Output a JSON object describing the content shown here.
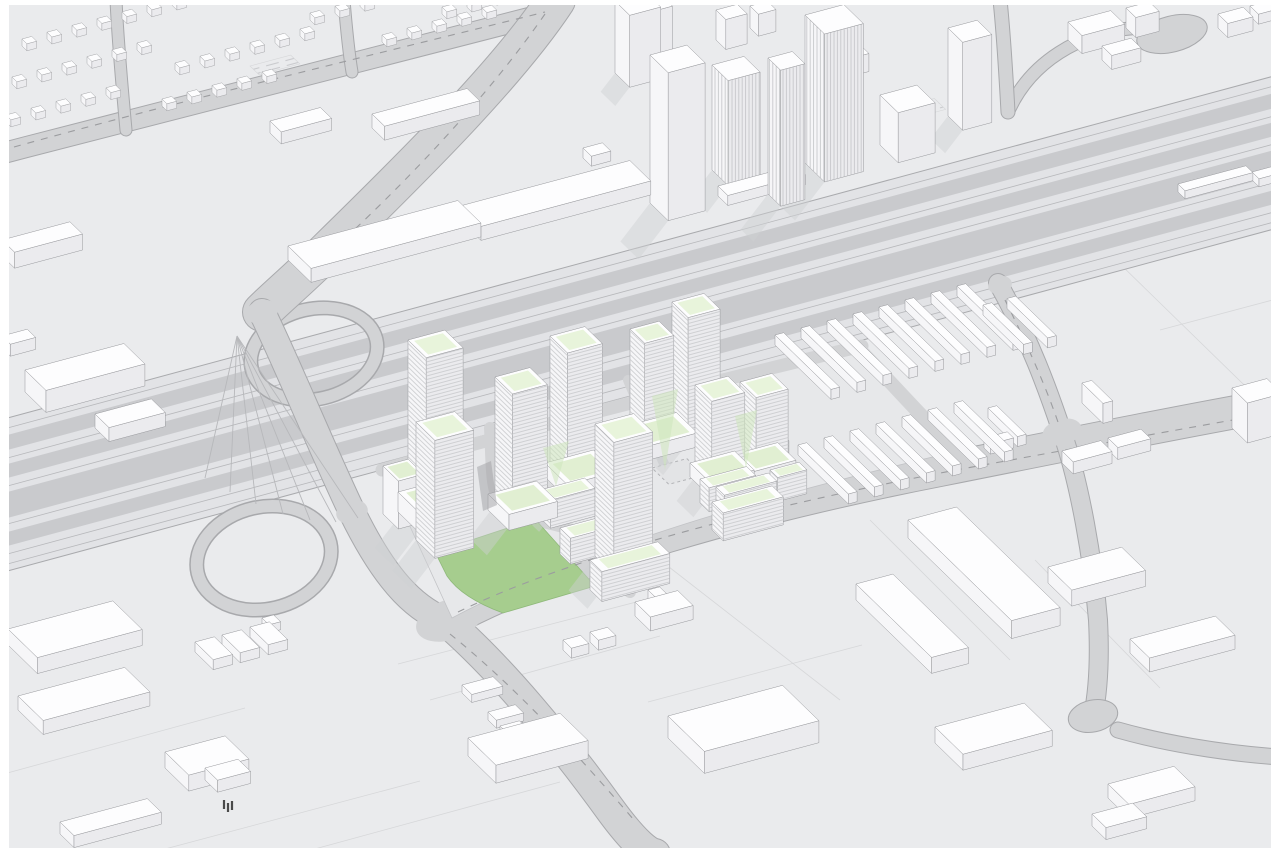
{
  "colors": {
    "frame": "#ffffff",
    "ground": "#eaebed",
    "block_line": "#d6d7d9",
    "corridor_base": "#e2e3e6",
    "corridor_band": "#c9cacd",
    "corridor_line": "#b7b8bb",
    "corridor_edge": "#a9aaad",
    "road": "#d2d3d5",
    "road_edge": "#a8a9ac",
    "road_dash": "#9b9c9f",
    "site": "#e7e8ea",
    "site_edge": "#c2c3c6",
    "lawn": "#a6cd8e",
    "lawn_edge": "#8fb97a",
    "roof_top": "#fdfdfe",
    "face_left": "#f6f6f8",
    "face_right": "#ebebee",
    "outline": "#97989c",
    "house_outline": "#a5a6a9",
    "mint": "#e8f4db",
    "mint_podium": "#e1efd2",
    "shadow": "#cfd0d3",
    "plaza": "#e3e4e6",
    "plaza_dash": "#b3b4b7",
    "stripe": "#c6c7ca",
    "vstripe": "#c2c3c6",
    "hatch": "#c9cacd",
    "shade_green": "#cde5bb",
    "gap_shadow": "#9fa0a3",
    "tree": "#4a4a4a"
  },
  "scene": {
    "corridor": {
      "top": [
        0,
        420
      ],
      "drop": 345.6,
      "height": 153,
      "bands": [
        [
          17,
          32
        ],
        [
          46,
          60
        ],
        [
          74,
          100
        ],
        [
          114,
          128
        ]
      ],
      "lines": [
        10,
        40,
        68,
        106,
        136,
        146
      ]
    },
    "roads": [
      {
        "n": "northwest-avenue",
        "d": "M 0,154 C 180,106 360,62 560,10",
        "w": 20
      },
      {
        "n": "cross-street-1",
        "d": "M 126,130 C 122,86 118,44 116,0",
        "w": 11
      },
      {
        "n": "cross-street-2",
        "d": "M 352,72 C 348,48 346,24 344,0",
        "w": 11
      },
      {
        "n": "north-approach-road",
        "d": "M 556,0 C 510,70 420,160 330,248 C 300,278 278,296 262,312",
        "w": 38
      },
      {
        "n": "overpass-bridge",
        "d": "M 262,312 C 290,370 318,440 352,512 C 390,590 420,610 447,622",
        "w": 26
      },
      {
        "n": "south-arterial",
        "d": "M 447,622 C 500,668 560,740 612,812 C 635,843 648,853 655,854",
        "w": 30
      },
      {
        "n": "development-front-street",
        "d": "M 447,622 C 560,560 760,505 940,470 C 1100,438 1200,418 1280,404",
        "w": 32
      },
      {
        "n": "east-street",
        "d": "M 998,283 C 1030,340 1048,390 1062,432 C 1080,484 1093,560 1098,620 C 1100,660 1098,692 1093,716",
        "w": 18
      },
      {
        "n": "cul-de-sac-street",
        "d": "M 1280,757 C 1220,753 1160,742 1118,730",
        "w": 15
      },
      {
        "n": "ramp-street",
        "d": "M 1008,112 C 1030,62 1080,32 1135,28",
        "w": 12
      },
      {
        "n": "top-right-road",
        "d": "M 1000,0 C 1004,38 1006,76 1008,112",
        "w": 13
      }
    ],
    "loops": [
      {
        "n": "loop-ramp-north",
        "cx": 314,
        "cy": 354,
        "rx": 64,
        "ry": 45,
        "rot": -13
      },
      {
        "n": "loop-ramp-south",
        "cx": 264,
        "cy": 558,
        "rx": 68,
        "ry": 51,
        "rot": -13
      }
    ],
    "teardrop": {
      "cx": 1172,
      "cy": 34,
      "rx": 36,
      "ry": 18,
      "rot": -14
    },
    "bulb": {
      "cx": 1093,
      "cy": 716,
      "rx": 25,
      "ry": 16,
      "rot": -12
    },
    "patches": [
      [
        449,
        620,
        34,
        20,
        -18
      ],
      [
        352,
        512,
        16,
        12,
        -14
      ],
      [
        262,
        312,
        16,
        12,
        -14
      ],
      [
        1062,
        432,
        20,
        13,
        -16
      ],
      [
        1000,
        285,
        12,
        9,
        -14
      ]
    ],
    "fan": {
      "apex": [
        237,
        336
      ],
      "feet": [
        [
          205,
          478
        ],
        [
          230,
          492
        ],
        [
          256,
          504
        ],
        [
          283,
          514
        ],
        [
          310,
          520
        ],
        [
          336,
          522
        ],
        [
          358,
          518
        ]
      ]
    },
    "inner_streets": [
      {
        "n": "development-back-street",
        "d": "M 382,470 C 520,430 700,385 862,346",
        "w": 13
      },
      {
        "n": "development-street-1",
        "d": "M 490,428 C 492,462 490,492 502,506 C 520,523 560,520 588,538 C 612,554 622,572 630,592",
        "w": 12
      },
      {
        "n": "development-street-2",
        "d": "M 628,380 C 645,420 658,452 668,472",
        "w": 10
      },
      {
        "n": "development-street-3",
        "d": "M 858,348 C 900,392 930,426 958,452",
        "w": 14
      }
    ],
    "dashes": [
      "M 458,612 C 575,555 775,502 1000,462 C 1120,440 1210,424 1278,412",
      "M 450,634 C 512,684 572,748 634,820",
      "M 545,14 C 498,82 430,158 354,230",
      "M 14,147 C 180,101 360,58 545,12",
      "M 1005,300 C 1030,350 1048,392 1060,428"
    ],
    "site": "M 385,472 L 858,345 L 962,450 C 800,488 598,540 452,618 Z",
    "lawn": "M 535,519 L 595,586 L 503,613 Q 462,598 447,576 L 435,552 Z",
    "plaza": {
      "x": 652,
      "y": 468,
      "w": 36,
      "d": 24
    },
    "parking_lots": [
      [
        250,
        66,
        42,
        13
      ],
      [
        884,
        112,
        52,
        16
      ]
    ],
    "lot_lines": [
      [
        0,
        775,
        245,
        708
      ],
      [
        150,
        853,
        420,
        781
      ],
      [
        300,
        853,
        560,
        782
      ],
      [
        430,
        700,
        660,
        636
      ],
      [
        648,
        702,
        862,
        645
      ],
      [
        870,
        520,
        1010,
        660
      ],
      [
        1035,
        560,
        1160,
        688
      ],
      [
        1160,
        330,
        1280,
        298
      ],
      [
        1185,
        207,
        1280,
        182
      ],
      [
        1118,
        262,
        1278,
        418
      ],
      [
        398,
        664,
        640,
        601
      ],
      [
        660,
        560,
        840,
        700
      ]
    ],
    "green_shades": [
      [
        [
          543,
          448
        ],
        [
          569,
          441
        ],
        [
          556,
          486
        ]
      ],
      [
        [
          652,
          396
        ],
        [
          678,
          389
        ],
        [
          665,
          470
        ]
      ],
      [
        [
          735,
          416
        ],
        [
          757,
          410
        ],
        [
          746,
          468
        ]
      ]
    ],
    "dark_gap": [
      [
        477,
        467
      ],
      [
        491,
        461
      ],
      [
        497,
        505
      ],
      [
        483,
        511
      ]
    ],
    "trees": [
      [
        224,
        800
      ],
      [
        228,
        803
      ],
      [
        232,
        801
      ]
    ],
    "boxes": [
      [
        408,
        505,
        38,
        26,
        165,
        "t",
        "proposed-tower-a1"
      ],
      [
        398,
        512,
        54,
        32,
        20,
        "p",
        "podium-a1"
      ],
      [
        383,
        514,
        26,
        22,
        48,
        "p",
        "terrace-a2"
      ],
      [
        416,
        540,
        40,
        27,
        118,
        "t",
        "proposed-tower-a2"
      ],
      [
        495,
        505,
        36,
        25,
        128,
        "t",
        "proposed-tower-b1"
      ],
      [
        488,
        510,
        50,
        30,
        16,
        "p",
        "podium-b1"
      ],
      [
        545,
        477,
        50,
        32,
        14,
        "p",
        "podium-c1"
      ],
      [
        550,
        478,
        36,
        25,
        142,
        "t",
        "proposed-tower-c1"
      ],
      [
        626,
        440,
        52,
        30,
        14,
        "p",
        "podium-d"
      ],
      [
        630,
        441,
        30,
        21,
        112,
        "t",
        "proposed-tower-d1"
      ],
      [
        672,
        427,
        33,
        23,
        125,
        "t",
        "proposed-tower-d2"
      ],
      [
        595,
        556,
        40,
        27,
        132,
        "t",
        "proposed-tower-e1"
      ],
      [
        690,
        477,
        46,
        28,
        14,
        "p",
        "podium-f1"
      ],
      [
        695,
        477,
        34,
        24,
        92,
        "t",
        "proposed-tower-f1"
      ],
      [
        735,
        466,
        44,
        26,
        12,
        "p",
        "podium-f2"
      ],
      [
        740,
        467,
        33,
        23,
        85,
        "t",
        "proposed-tower-f2"
      ],
      [
        540,
        518,
        46,
        15,
        28,
        "s",
        "midrise-slab-1"
      ],
      [
        560,
        554,
        50,
        15,
        26,
        "s",
        "midrise-slab-2"
      ],
      [
        590,
        590,
        70,
        17,
        30,
        "s",
        "midrise-slab-3"
      ],
      [
        712,
        530,
        62,
        16,
        28,
        "s",
        "midrise-slab-4"
      ],
      [
        716,
        527,
        54,
        12,
        40,
        "s",
        "midrise-slab-4-upper"
      ],
      [
        700,
        503,
        48,
        13,
        24,
        "s",
        "midrise-slab-5"
      ],
      [
        756,
        468,
        26,
        11,
        28,
        "s",
        "midrise-slab-6"
      ],
      [
        770,
        494,
        30,
        11,
        24,
        "s",
        "midrise-slab-7"
      ],
      [
        650,
        203,
        38,
        26,
        148,
        "w",
        "existing-tower-1"
      ],
      [
        615,
        73,
        32,
        21,
        72,
        "w",
        "existing-tower-2"
      ],
      [
        712,
        170,
        33,
        23,
        105,
        "v",
        "existing-tower-3"
      ],
      [
        768,
        194,
        25,
        18,
        136,
        "v",
        "existing-tower-4"
      ],
      [
        805,
        163,
        40,
        28,
        148,
        "v",
        "existing-tower-5"
      ],
      [
        718,
        196,
        80,
        14,
        10,
        "w",
        "existing-podium"
      ],
      [
        880,
        145,
        38,
        26,
        50,
        "w",
        "existing-midrise"
      ],
      [
        948,
        116,
        30,
        21,
        88,
        "w",
        "existing-tower-6"
      ],
      [
        636,
        50,
        26,
        16,
        48,
        "w",
        "building"
      ],
      [
        716,
        40,
        22,
        14,
        30,
        "w",
        "building"
      ],
      [
        750,
        28,
        18,
        12,
        22,
        "w",
        "building"
      ],
      [
        843,
        68,
        18,
        12,
        18,
        "w",
        "building"
      ],
      [
        270,
        133,
        52,
        16,
        12,
        "w",
        "retail-box-1"
      ],
      [
        372,
        128,
        98,
        18,
        14,
        "w",
        "retail-box-2"
      ],
      [
        288,
        260,
        175,
        33,
        14,
        "w",
        "retail-box-3"
      ],
      [
        460,
        220,
        175,
        30,
        14,
        "w",
        "retail-box-4"
      ],
      [
        583,
        158,
        20,
        12,
        10,
        "w",
        "building"
      ],
      [
        2,
        256,
        70,
        18,
        16,
        "w",
        "building"
      ],
      [
        2,
        348,
        26,
        12,
        12,
        "w",
        "building"
      ],
      [
        25,
        392,
        102,
        30,
        22,
        "w",
        "building"
      ],
      [
        95,
        428,
        58,
        20,
        14,
        "w",
        "building"
      ],
      [
        8,
        645,
        108,
        42,
        16,
        "w",
        "warehouse"
      ],
      [
        18,
        710,
        110,
        36,
        14,
        "w",
        "warehouse"
      ],
      [
        195,
        652,
        20,
        26,
        10,
        "w",
        "shed"
      ],
      [
        222,
        645,
        20,
        26,
        10,
        "w",
        "shed"
      ],
      [
        250,
        637,
        20,
        26,
        10,
        "w",
        "shed"
      ],
      [
        262,
        626,
        12,
        10,
        8,
        "w",
        "shed"
      ],
      [
        165,
        768,
        62,
        34,
        16,
        "w",
        "warehouse"
      ],
      [
        60,
        834,
        90,
        20,
        12,
        "w",
        "warehouse"
      ],
      [
        205,
        780,
        34,
        18,
        12,
        "w",
        "building"
      ],
      [
        212,
        776,
        10,
        8,
        19,
        "w",
        "rooftop-unit"
      ],
      [
        468,
        756,
        95,
        40,
        18,
        "w",
        "big-box-store"
      ],
      [
        500,
        752,
        20,
        14,
        26,
        "w",
        "rooftop-unit"
      ],
      [
        635,
        616,
        44,
        22,
        14,
        "w",
        "building"
      ],
      [
        648,
        612,
        12,
        10,
        22,
        "w",
        "rooftop-unit"
      ],
      [
        563,
        650,
        18,
        12,
        10,
        "w",
        "building"
      ],
      [
        590,
        642,
        18,
        12,
        10,
        "w",
        "building"
      ],
      [
        462,
        693,
        32,
        14,
        8,
        "w",
        "building"
      ],
      [
        488,
        720,
        28,
        12,
        8,
        "w",
        "building"
      ],
      [
        668,
        738,
        118,
        52,
        22,
        "w",
        "warehouse"
      ],
      [
        908,
        538,
        50,
        148,
        18,
        "w",
        "warehouse-long-1"
      ],
      [
        856,
        600,
        38,
        108,
        16,
        "w",
        "warehouse-long-2"
      ],
      [
        935,
        743,
        92,
        40,
        16,
        "w",
        "warehouse"
      ],
      [
        1048,
        583,
        76,
        34,
        16,
        "w",
        "warehouse"
      ],
      [
        1130,
        653,
        88,
        28,
        14,
        "w",
        "warehouse"
      ],
      [
        1108,
        798,
        68,
        30,
        14,
        "w",
        "warehouse"
      ],
      [
        1092,
        826,
        42,
        20,
        12,
        "w",
        "warehouse"
      ],
      [
        1062,
        463,
        40,
        16,
        12,
        "w",
        "building"
      ],
      [
        1108,
        450,
        34,
        14,
        12,
        "w",
        "building"
      ],
      [
        1082,
        403,
        10,
        30,
        20,
        "w",
        "building"
      ],
      [
        1232,
        428,
        36,
        22,
        40,
        "w",
        "building"
      ],
      [
        1068,
        40,
        44,
        20,
        18,
        "w",
        "building"
      ],
      [
        1102,
        60,
        30,
        14,
        14,
        "w",
        "building"
      ],
      [
        1126,
        28,
        24,
        14,
        20,
        "w",
        "building"
      ],
      [
        1218,
        28,
        26,
        14,
        14,
        "w",
        "building"
      ],
      [
        1250,
        16,
        20,
        12,
        10,
        "w",
        "building"
      ],
      [
        1178,
        192,
        70,
        10,
        8,
        "w",
        "shed"
      ],
      [
        1252,
        180,
        40,
        10,
        8,
        "w",
        "shed"
      ]
    ],
    "shed_bands": [
      {
        "name": "shed-row-north",
        "start": [
          775,
          345
        ],
        "n": 8,
        "step": [
          26,
          -7
        ],
        "w": 9,
        "d": 80,
        "h": 10
      },
      {
        "name": "shed-row-north-ext",
        "start": [
          983,
          315
        ],
        "n": 2,
        "step": [
          24,
          -6.5
        ],
        "w": 9,
        "d": 58,
        "h": 10
      },
      {
        "name": "shed-row-south",
        "start": [
          798,
          455
        ],
        "n": 7,
        "step": [
          26,
          -7
        ],
        "w": 9,
        "d": 72,
        "h": 10
      },
      {
        "name": "shed-l",
        "start": [
          988,
          418
        ],
        "n": 1,
        "step": [
          0,
          0
        ],
        "w": 9,
        "d": 42,
        "h": 10
      },
      {
        "name": "shed-l-foot",
        "start": [
          984,
          448
        ],
        "n": 1,
        "step": [
          0,
          0
        ],
        "w": 24,
        "d": 9,
        "h": 10
      }
    ],
    "house_rows": [
      {
        "start": [
          22,
          46
        ],
        "n": 7,
        "step": [
          25,
          -6.8
        ]
      },
      {
        "start": [
          12,
          84
        ],
        "n": 6,
        "step": [
          25,
          -6.8
        ]
      },
      {
        "start": [
          6,
          122
        ],
        "n": 5,
        "step": [
          25,
          -6.8
        ]
      },
      {
        "start": [
          175,
          70
        ],
        "n": 6,
        "step": [
          25,
          -6.8
        ]
      },
      {
        "start": [
          162,
          106
        ],
        "n": 5,
        "step": [
          25,
          -6.8
        ]
      },
      {
        "start": [
          310,
          20
        ],
        "n": 4,
        "step": [
          25,
          -6.8
        ]
      },
      {
        "start": [
          382,
          42
        ],
        "n": 5,
        "step": [
          25,
          -6.8
        ]
      },
      {
        "start": [
          442,
          14
        ],
        "n": 3,
        "step": [
          25,
          -6.8
        ]
      }
    ],
    "house_size": {
      "w": 10,
      "d": 7,
      "h": 7
    }
  }
}
